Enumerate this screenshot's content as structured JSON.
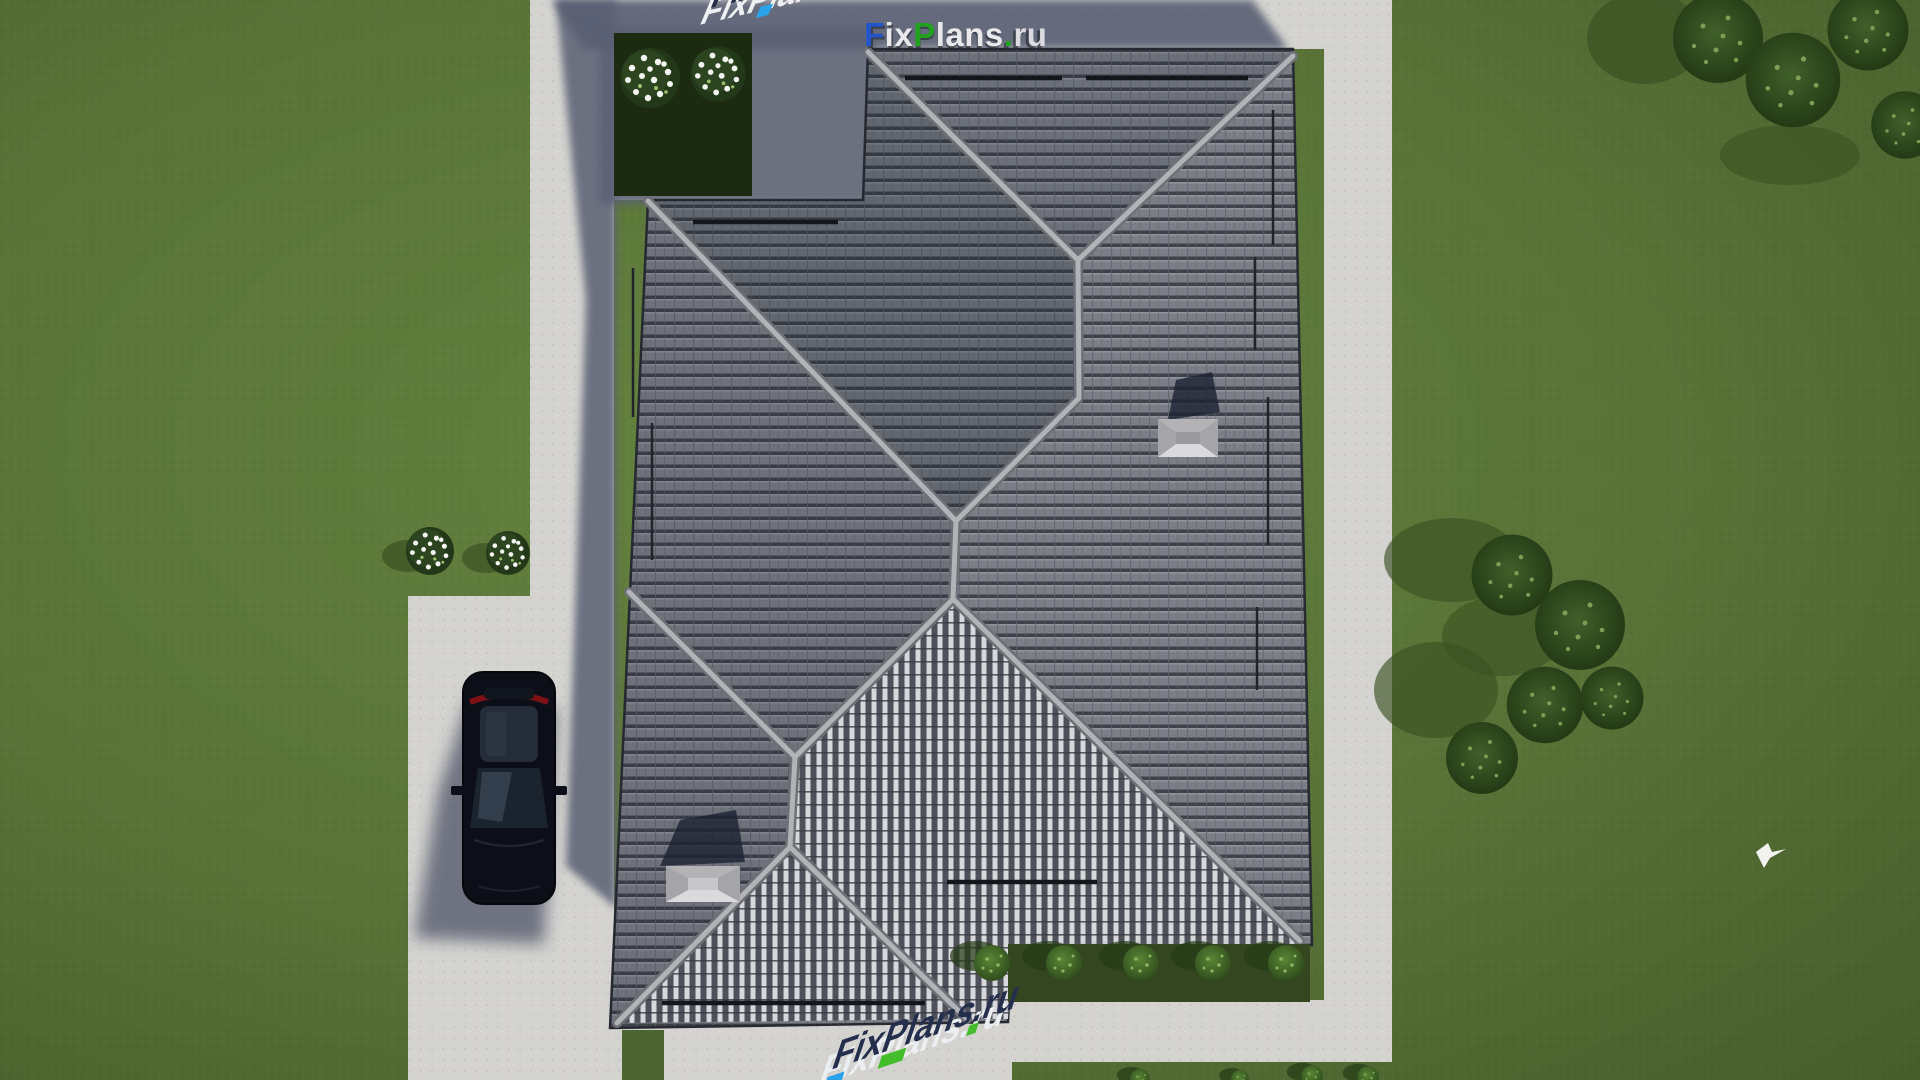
{
  "scene": {
    "description": "Aerial top-down 3D render of a house hip roof with gray tiles, surrounded by lawn, concrete paths, driveway with parked car, hedges, flower bushes and trees",
    "watermarks": {
      "top": {
        "text": "FixPlans.ru",
        "segments": [
          {
            "text": "F",
            "color": "#2255cc"
          },
          {
            "text": "ix",
            "color": "#e9e9ec"
          },
          {
            "text": "P",
            "color": "#21a11f"
          },
          {
            "text": "lans",
            "color": "#e9e9ec"
          },
          {
            "text": ".",
            "color": "#21a11f"
          },
          {
            "text": "ru",
            "color": "#dcdce0"
          }
        ]
      },
      "bottom_projected": {
        "text": "FixPlans.ru",
        "style": "3D extruded watermark projected onto terrace pavement, skewed"
      },
      "top_left_fragment": {
        "text": "FixPlans.ru",
        "style": "partial projected watermark cut off at top edge"
      }
    },
    "house": {
      "roof_type": "hip roof, dark gray concrete tiles",
      "features": [
        "north wing with V hip junction",
        "long west hip",
        "bright south-facing gable triangle",
        "bright porch triangle (south-west)",
        "2 chimney caps with cast shadows",
        "snow-guard bars",
        "gutter pipes"
      ]
    },
    "vehicles": {
      "car": {
        "color": "black / dark navy",
        "state": "parked on driveway, facing south, red taillights at rear"
      }
    },
    "landscaping": {
      "hedge_bed_top_left": {
        "flower_bushes": 2
      },
      "lawn_flower_bushes_left": 2,
      "bed_shrubs_bottom_right": 5,
      "tree_cluster_right": 5,
      "trees_top_right_corner": 4,
      "small_bushes_bottom_edge": 4,
      "bird_flying": 1
    },
    "colors": {
      "grass": "#5b7839",
      "grass_dark": "#47602e",
      "pavement": "#d4d3d0",
      "cast_shadow": "#5a6173",
      "roof_tile": "#7b7e86",
      "roof_tile_gap": "#3e414a",
      "roof_bright_rib": "#d7d8db",
      "ridge_cap": "#b2b3b7",
      "hedge": "#1d2a12",
      "car_body": "#0c0f17",
      "car_taillight": "#7e1115",
      "watermark_blue": "#2255cc",
      "watermark_green": "#21a11f",
      "watermark_navy": "#242e4d",
      "watermark_white": "#e9e9ec"
    }
  }
}
